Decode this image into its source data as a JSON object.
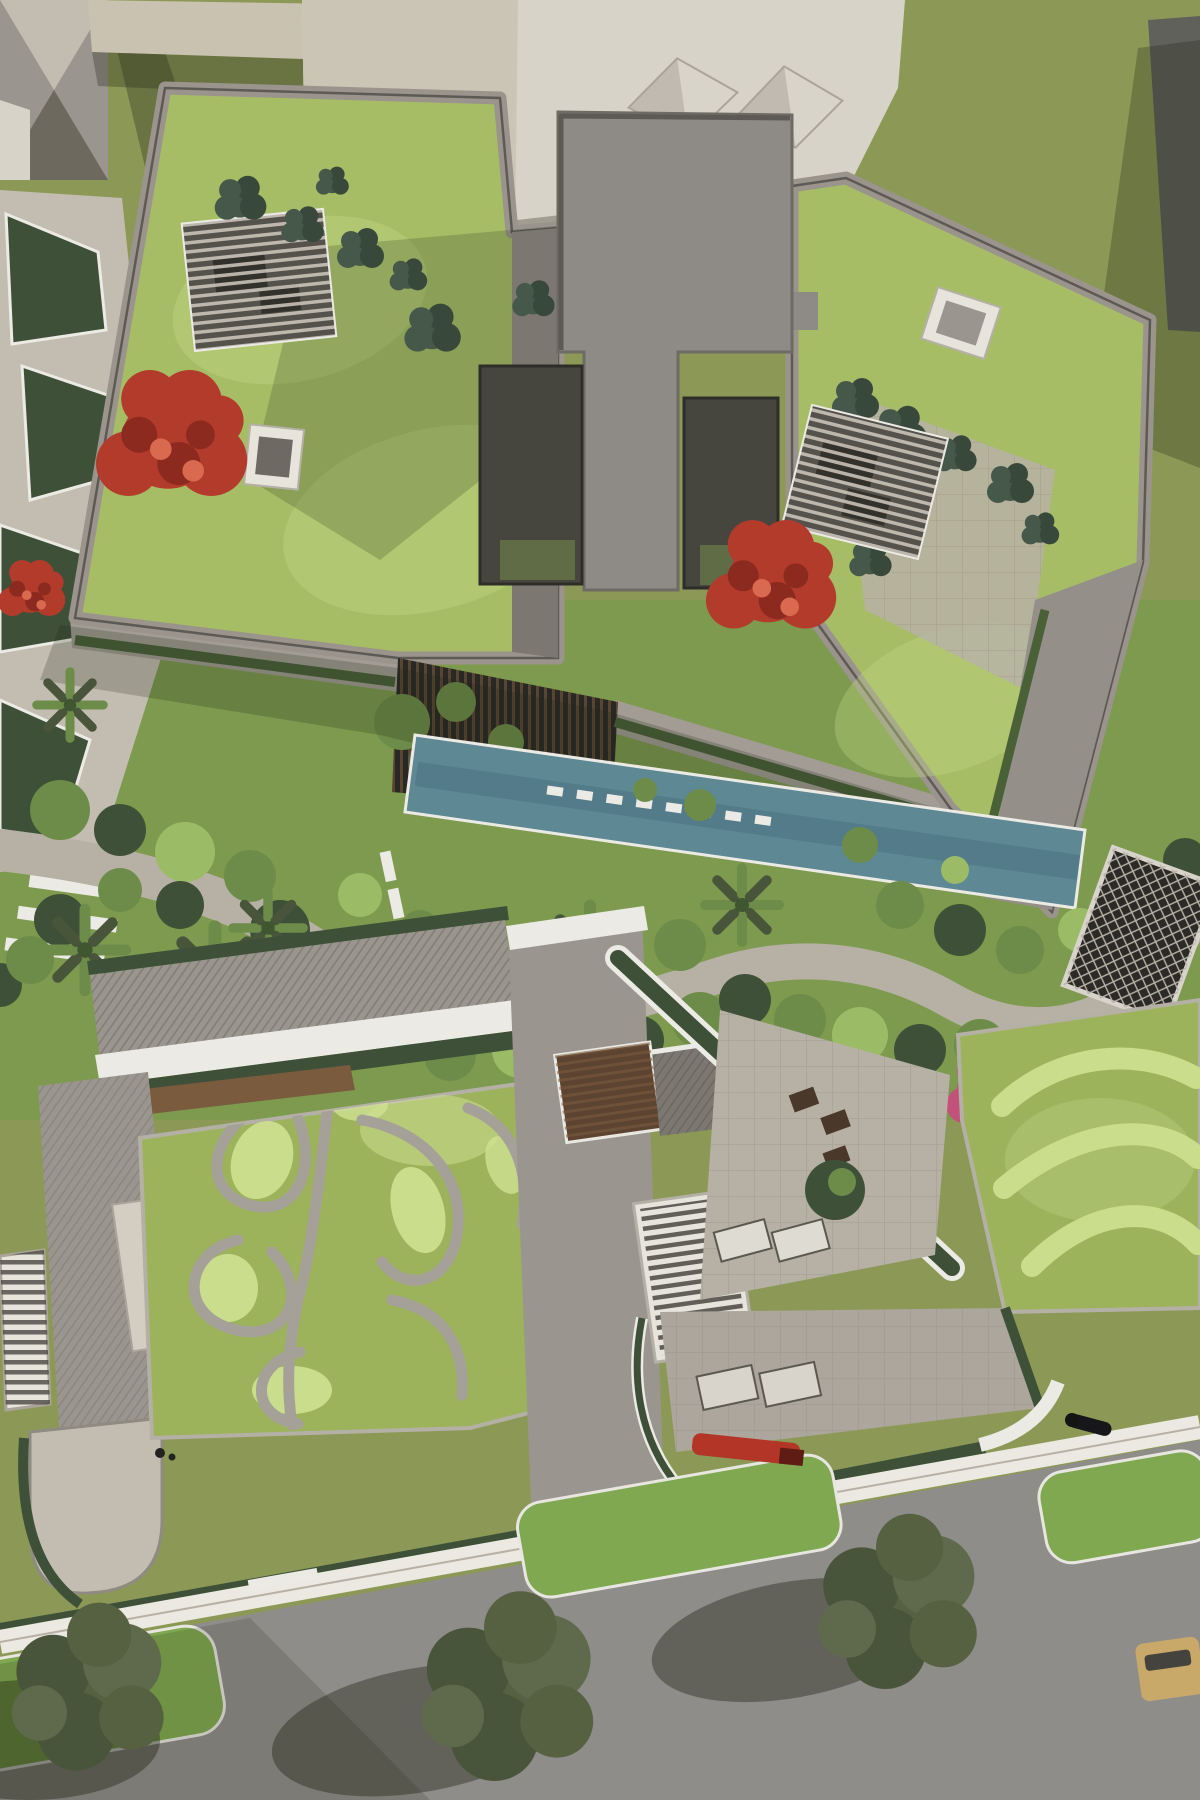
{
  "meta": {
    "title": "Top-down aerial architectural rendering of a residential complex with sedum green roofs, cross-shaped roof core, courtyard gardens, lap pool, leaf-patterned roof and a tree-lined street",
    "style": "photorealistic 3D visualization",
    "view": "plan / bird's-eye",
    "canvas": {
      "width": 1200,
      "height": 1800
    }
  },
  "palette": {
    "grass_field": "#8c9956",
    "grass_light": "#9aa862",
    "roof_lawn": "#a6bd66",
    "roof_lawn_light": "#c3d684",
    "leaf_roof": "#9cb35c",
    "leaf_roof_light": "#cfe192",
    "swirl_light": "#c9dd8c",
    "shrub_dark": "#3e5138",
    "shrub_mid": "#6d8c49",
    "shrub_light": "#9cbb66",
    "teal_bush": "#46584a",
    "teal_bush_dark": "#38493c",
    "concrete_light": "#c3bdb1",
    "concrete_mid": "#9a958e",
    "concrete_dark": "#7c7871",
    "parapet_grey": "#9a948c",
    "parapet_white": "#eceae4",
    "core_grey": "#8e8a85",
    "core_edge": "#5d5a55",
    "courtyard_dark": "#46463f",
    "atrium_dark": "#2a2824",
    "wood": "#7a5b3e",
    "wood_dark": "#5d4430",
    "pool_teal": "#5d8894",
    "pool_deep": "#4d7382",
    "path_light": "#b7b1a5",
    "gravel_path": "#a5a199",
    "hedge_green": "#4a6138",
    "white_building": "#d8d3c8",
    "beige_building": "#c9c2b1",
    "dark_building": "#61615b",
    "street_asphalt": "#8f8d89",
    "sidewalk_white": "#ece9e2",
    "verge_green": "#7fa850",
    "tree_olive": "#556141",
    "tree_olive_dark": "#49553a",
    "tree_grey": "#5f6a4c",
    "red_tree": "#b23b2c",
    "red_tree_dark": "#8c2a1f",
    "red_tree_light": "#d9694f",
    "pink_flower": "#c2527a",
    "scooter_red": "#b23527",
    "car_tan": "#c9a96a",
    "skylight_white": "#e7e4dc",
    "glass_dark": "#56534d",
    "shadow_soft": "rgba(30,34,20,0.30)",
    "shadow_strong": "rgba(25,28,16,0.38)"
  },
  "scene": {
    "regions": [
      {
        "name": "upper-residential-block",
        "label": "Large apartment block with sedum green roof"
      },
      {
        "name": "cross-shaped-core",
        "label": "Grey cross-shaped roof core with two sunken dark courtyards"
      },
      {
        "name": "roof-pergolas",
        "label": "Two slatted rooftop pergolas with furniture"
      },
      {
        "name": "flowering-trees",
        "label": "Red flowering trees on the roof garden"
      },
      {
        "name": "neighbor-buildings",
        "label": "Neighbouring white and beige buildings with pyramid skylights"
      },
      {
        "name": "courtyard-garden",
        "label": "Central landscaped garden with winding stone paths"
      },
      {
        "name": "lap-pool",
        "label": "Teal reflecting pool crossed by white stepping stones"
      },
      {
        "name": "palm-trees",
        "label": "Palm trees among courtyard planting"
      },
      {
        "name": "solar-trellis",
        "label": "Dark lattice trellis panel beside the path"
      },
      {
        "name": "lower-left-block",
        "label": "Lower building with leaf-motif sedum roof"
      },
      {
        "name": "leaf-pattern-roof",
        "label": "Gravel swirl leaf pattern on the green roof"
      },
      {
        "name": "skylight-grills",
        "label": "White louvred skylight grills"
      },
      {
        "name": "triangular-terrace",
        "label": "Triangular paved terrace with seating and loungers"
      },
      {
        "name": "swirl-roof",
        "label": "Green roof with light mowed S-curve stripes"
      },
      {
        "name": "street",
        "label": "Asphalt street with planted verges and kerb lines"
      },
      {
        "name": "street-trees",
        "label": "Olive street trees casting long shadows"
      },
      {
        "name": "vehicles",
        "label": "Red scooter and beige parked car"
      },
      {
        "name": "pedestrians",
        "label": "Pedestrians and a dog on the pavement"
      }
    ]
  }
}
